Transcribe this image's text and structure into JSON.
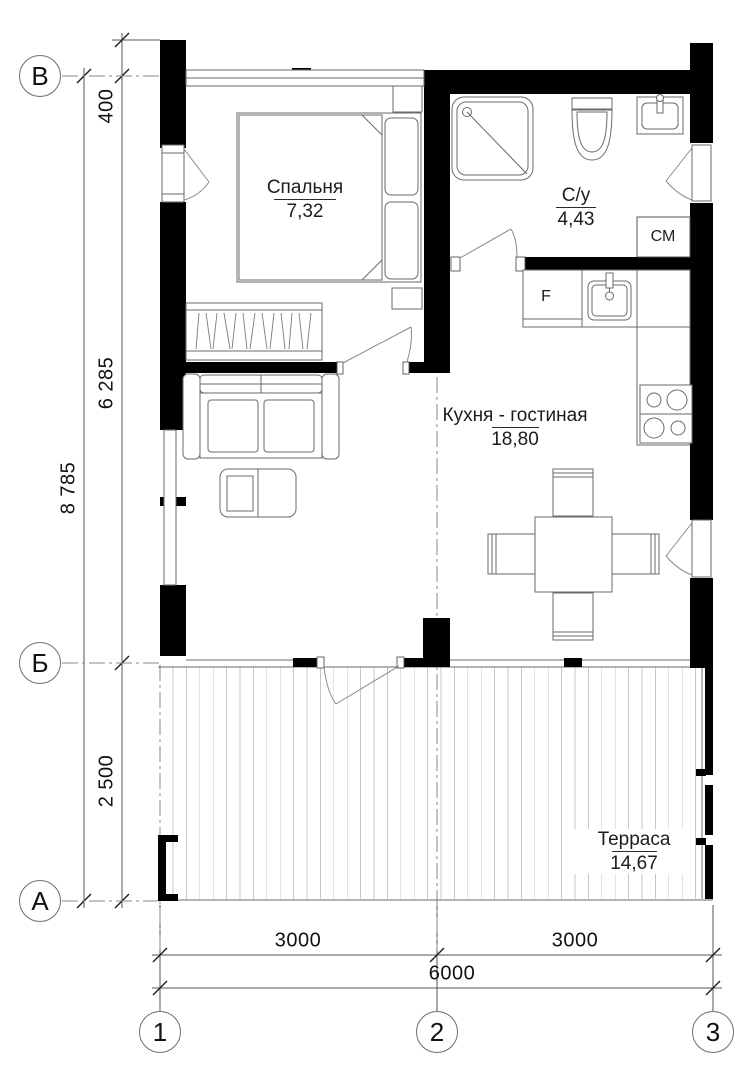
{
  "plan": {
    "title": "floor-plan",
    "rooms": {
      "bedroom": {
        "name": "Спальня",
        "area": "7,32"
      },
      "bathroom": {
        "name": "С/у",
        "area": "4,43"
      },
      "kitchen_living": {
        "name": "Кухня - гостиная",
        "area": "18,80"
      },
      "terrace": {
        "name": "Терраса",
        "area": "14,67"
      }
    },
    "appliances": {
      "washing_machine": "СМ",
      "fridge": "F"
    },
    "axes": {
      "row_top": "В",
      "row_mid": "Б",
      "row_bottom": "А",
      "col_left": "1",
      "col_mid": "2",
      "col_right": "3"
    },
    "dimensions": {
      "top_offset": "400",
      "upper_span": "6 285",
      "lower_span": "2 500",
      "total_height": "8 785",
      "left_span": "3000",
      "right_span": "3000",
      "total_width": "6000"
    },
    "colors": {
      "wall": "#000000",
      "line": "#6a6a6a",
      "hatch": "#c6c6c6",
      "text": "#1a1a1a"
    }
  }
}
